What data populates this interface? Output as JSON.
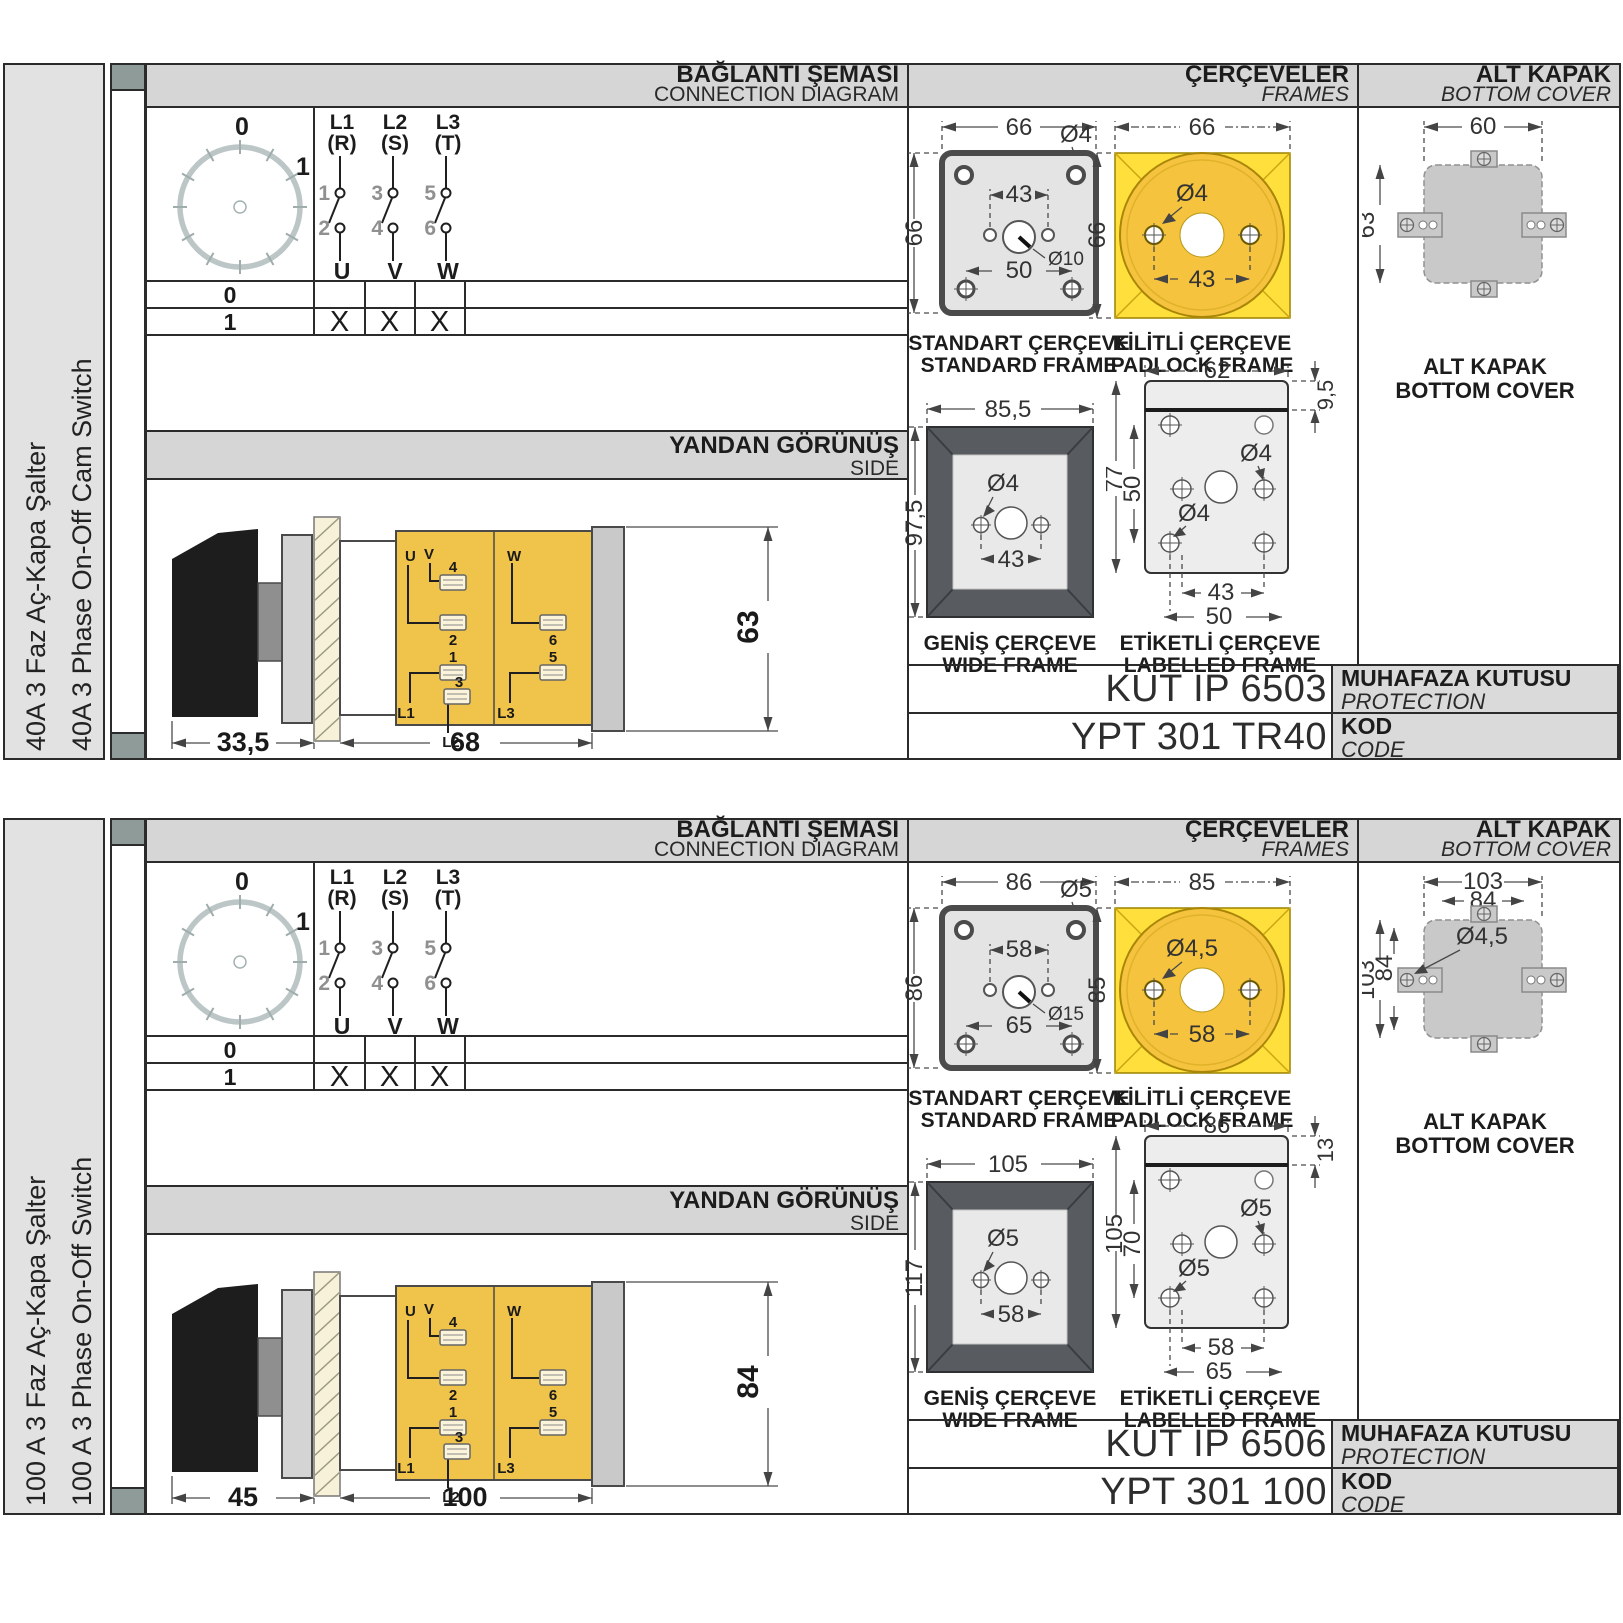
{
  "sections": [
    {
      "sidebar": {
        "title_tr": "40A 3 Faz Aç-Kapa Şalter",
        "title_en": "40A 3 Phase On-Off Cam Switch"
      },
      "headers": {
        "connection_tr": "BAĞLANTI ŞEMASI",
        "connection_en": "CONNECTION DIAGRAM",
        "frames_tr": "ÇERÇEVELER",
        "frames_en": "FRAMES",
        "cover_tr": "ALT KAPAK",
        "cover_en": "BOTTOM COVER"
      },
      "connection": {
        "dial": {
          "zero": "0",
          "one": "1"
        },
        "poles": [
          {
            "line": "L1",
            "phase": "(R)",
            "top": "1",
            "bottom": "2",
            "out": "U"
          },
          {
            "line": "L2",
            "phase": "(S)",
            "top": "3",
            "bottom": "4",
            "out": "V"
          },
          {
            "line": "L3",
            "phase": "(T)",
            "top": "5",
            "bottom": "6",
            "out": "W"
          }
        ],
        "table": {
          "rows": [
            {
              "pos": "0",
              "marks": [
                "",
                "",
                ""
              ]
            },
            {
              "pos": "1",
              "marks": [
                "X",
                "X",
                "X"
              ]
            }
          ]
        }
      },
      "side": {
        "title_tr": "YANDAN GÖRÜNÜŞ",
        "title_en": "SIDE",
        "terminals": {
          "u": "U",
          "v": "V",
          "w": "W",
          "n1": "1",
          "n2": "2",
          "n3": "3",
          "n4": "4",
          "n5": "5",
          "n6": "6",
          "l1": "L1",
          "l2": "L2",
          "l3": "L3"
        },
        "dims": {
          "front": "33,5",
          "body": "68",
          "height": "63"
        }
      },
      "frames": {
        "standard": {
          "label_tr": "STANDART ÇERÇEVE",
          "label_en": "STANDARD FRAME",
          "w": "66",
          "h": "66",
          "hole": "Ø4",
          "pitch": "43",
          "center": "Ø10",
          "lower": "50"
        },
        "padlock": {
          "label_tr": "KİLİTLİ ÇERÇEVE",
          "label_en": "PADLOCK FRAME",
          "w": "66",
          "h": "66",
          "hole": "Ø4",
          "pitch": "43"
        },
        "wide": {
          "label_tr": "GENİŞ ÇERÇEVE",
          "label_en": "WIDE FRAME",
          "w": "85,5",
          "h": "97,5",
          "hole": "Ø4",
          "pitch": "43"
        },
        "labelled": {
          "label_tr": "ETİKETLİ ÇERÇEVE",
          "label_en": "LABELLED FRAME",
          "w": "62",
          "strip": "9,5",
          "h": "77",
          "inner_h": "50",
          "hole_a": "Ø4",
          "hole_b": "Ø4",
          "pitch": "43",
          "lower": "50"
        }
      },
      "cover": {
        "label_tr": "ALT KAPAK",
        "label_en": "BOTTOM COVER",
        "w_outer": "60",
        "w_inner": "",
        "h_outer": "63",
        "h_inner": "",
        "hole": ""
      },
      "codes": {
        "enclosure": "KUT IP 6503",
        "enclosure_tr": "MUHAFAZA KUTUSU",
        "enclosure_en": "PROTECTION ENCLOSURE",
        "code": "YPT 301 TR40",
        "code_tr": "KOD",
        "code_en": "CODE"
      }
    },
    {
      "sidebar": {
        "title_tr": "100 A 3 Faz Aç-Kapa Şalter",
        "title_en": "100 A 3 Phase On-Off Switch"
      },
      "headers": {
        "connection_tr": "BAĞLANTI ŞEMASI",
        "connection_en": "CONNECTION DIAGRAM",
        "frames_tr": "ÇERÇEVELER",
        "frames_en": "FRAMES",
        "cover_tr": "ALT KAPAK",
        "cover_en": "BOTTOM COVER"
      },
      "connection": {
        "dial": {
          "zero": "0",
          "one": "1"
        },
        "poles": [
          {
            "line": "L1",
            "phase": "(R)",
            "top": "1",
            "bottom": "2",
            "out": "U"
          },
          {
            "line": "L2",
            "phase": "(S)",
            "top": "3",
            "bottom": "4",
            "out": "V"
          },
          {
            "line": "L3",
            "phase": "(T)",
            "top": "5",
            "bottom": "6",
            "out": "W"
          }
        ],
        "table": {
          "rows": [
            {
              "pos": "0",
              "marks": [
                "",
                "",
                ""
              ]
            },
            {
              "pos": "1",
              "marks": [
                "X",
                "X",
                "X"
              ]
            }
          ]
        }
      },
      "side": {
        "title_tr": "YANDAN GÖRÜNÜŞ",
        "title_en": "SIDE",
        "terminals": {
          "u": "U",
          "v": "V",
          "w": "W",
          "n1": "1",
          "n2": "2",
          "n3": "3",
          "n4": "4",
          "n5": "5",
          "n6": "6",
          "l1": "L1",
          "l2": "L2",
          "l3": "L3"
        },
        "dims": {
          "front": "45",
          "body": "100",
          "height": "84"
        }
      },
      "frames": {
        "standard": {
          "label_tr": "STANDART ÇERÇEVE",
          "label_en": "STANDARD FRAME",
          "w": "86",
          "h": "86",
          "hole": "Ø5",
          "pitch": "58",
          "center": "Ø15",
          "lower": "65"
        },
        "padlock": {
          "label_tr": "KİLİTLİ ÇERÇEVE",
          "label_en": "PADLOCK FRAME",
          "w": "85",
          "h": "85",
          "hole": "Ø4,5",
          "pitch": "58"
        },
        "wide": {
          "label_tr": "GENİŞ ÇERÇEVE",
          "label_en": "WIDE FRAME",
          "w": "105",
          "h": "117",
          "hole": "Ø5",
          "pitch": "58"
        },
        "labelled": {
          "label_tr": "ETİKETLİ ÇERÇEVE",
          "label_en": "LABELLED FRAME",
          "w": "86",
          "strip": "13",
          "h": "105",
          "inner_h": "70",
          "hole_a": "Ø5",
          "hole_b": "Ø5",
          "pitch": "58",
          "lower": "65"
        }
      },
      "cover": {
        "label_tr": "ALT KAPAK",
        "label_en": "BOTTOM COVER",
        "w_outer": "103",
        "w_inner": "84",
        "h_outer": "103",
        "h_inner": "84",
        "hole": "Ø4,5"
      },
      "codes": {
        "enclosure": "KUT IP 6506",
        "enclosure_tr": "MUHAFAZA KUTUSU",
        "enclosure_en": "PROTECTION ENCLOSURE",
        "code": "YPT 301 100",
        "code_tr": "KOD",
        "code_en": "CODE"
      }
    }
  ]
}
